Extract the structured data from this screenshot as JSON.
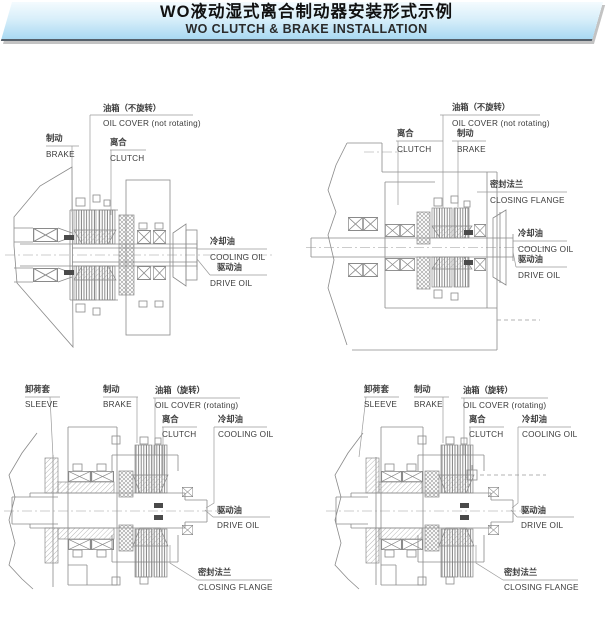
{
  "header": {
    "title_zh": "WO液动湿式离合制动器安装形式示例",
    "title_en": "WO CLUTCH & BRAKE INSTALLATION"
  },
  "colors": {
    "banner_gradient_top": "#f4fbfe",
    "banner_gradient_bottom": "#a9d9f2",
    "banner_edge": "#55606a",
    "banner_shadow": "#c3c3c3",
    "drawing_line": "#8a8a8a",
    "label_text": "#3b3b3b"
  },
  "diagrams": {
    "top_left": {
      "labels": {
        "oil_cover": {
          "zh": "油箱（不旋转）",
          "en": "OIL COVER (not rotating)"
        },
        "brake": {
          "zh": "制动",
          "en": "BRAKE"
        },
        "clutch": {
          "zh": "离合",
          "en": "CLUTCH"
        },
        "cooling_oil": {
          "zh": "冷却油",
          "en": "COOLING OIL"
        },
        "drive_oil": {
          "zh": "驱动油",
          "en": "DRIVE OIL"
        }
      }
    },
    "top_right": {
      "labels": {
        "clutch": {
          "zh": "离合",
          "en": "CLUTCH"
        },
        "oil_cover": {
          "zh": "油箱（不旋转）",
          "en": "OIL COVER (not rotating)"
        },
        "brake": {
          "zh": "制动",
          "en": "BRAKE"
        },
        "closing_flange": {
          "zh": "密封法兰",
          "en": "CLOSING FLANGE"
        },
        "cooling_oil": {
          "zh": "冷却油",
          "en": "COOLING OIL"
        },
        "drive_oil": {
          "zh": "驱动油",
          "en": "DRIVE OIL"
        }
      }
    },
    "bottom_left": {
      "labels": {
        "sleeve": {
          "zh": "卸荷套",
          "en": "SLEEVE"
        },
        "brake": {
          "zh": "制动",
          "en": "BRAKE"
        },
        "oil_cover": {
          "zh": "油箱（旋转）",
          "en": "OIL COVER (rotating)"
        },
        "clutch": {
          "zh": "离合",
          "en": "CLUTCH"
        },
        "cooling_oil": {
          "zh": "冷却油",
          "en": "COOLING OIL"
        },
        "drive_oil": {
          "zh": "驱动油",
          "en": "DRIVE OIL"
        },
        "closing_flange": {
          "zh": "密封法兰",
          "en": "CLOSING FLANGE"
        }
      }
    },
    "bottom_right": {
      "labels": {
        "sleeve": {
          "zh": "卸荷套",
          "en": "SLEEVE"
        },
        "brake": {
          "zh": "制动",
          "en": "BRAKE"
        },
        "oil_cover": {
          "zh": "油箱（旋转）",
          "en": "OIL COVER (rotating)"
        },
        "clutch": {
          "zh": "离合",
          "en": "CLUTCH"
        },
        "cooling_oil": {
          "zh": "冷却油",
          "en": "COOLING OIL"
        },
        "drive_oil": {
          "zh": "驱动油",
          "en": "DRIVE OIL"
        },
        "closing_flange": {
          "zh": "密封法兰",
          "en": "CLOSING FLANGE"
        }
      }
    }
  }
}
